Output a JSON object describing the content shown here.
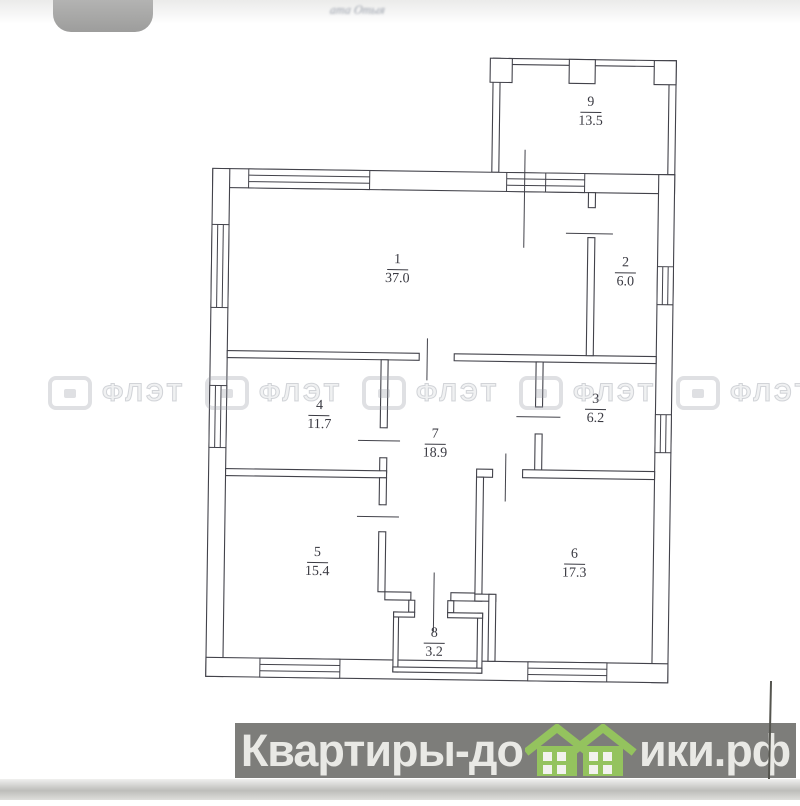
{
  "header": {
    "cutoff_text": "ата Отыя"
  },
  "floor_plan": {
    "rooms": [
      {
        "number": "1",
        "area": "37.0"
      },
      {
        "number": "2",
        "area": "6.0"
      },
      {
        "number": "3",
        "area": "6.2"
      },
      {
        "number": "4",
        "area": "11.7"
      },
      {
        "number": "5",
        "area": "15.4"
      },
      {
        "number": "6",
        "area": "17.3"
      },
      {
        "number": "7",
        "area": "18.9"
      },
      {
        "number": "8",
        "area": "3.2"
      },
      {
        "number": "9",
        "area": "13.5"
      }
    ],
    "line_color": "#42424a"
  },
  "agency_watermark": {
    "label": "ФЛЭТ",
    "color": "#9499a3"
  },
  "footer_watermark": {
    "text_before_houses": "Квартиры-до",
    "text_after_houses": "ики.рф",
    "full_text": "Квартиры-домики.рф",
    "bar_color": "#7d7d7a",
    "text_color": "#e9e9e5",
    "house_color": "#94c35e"
  }
}
